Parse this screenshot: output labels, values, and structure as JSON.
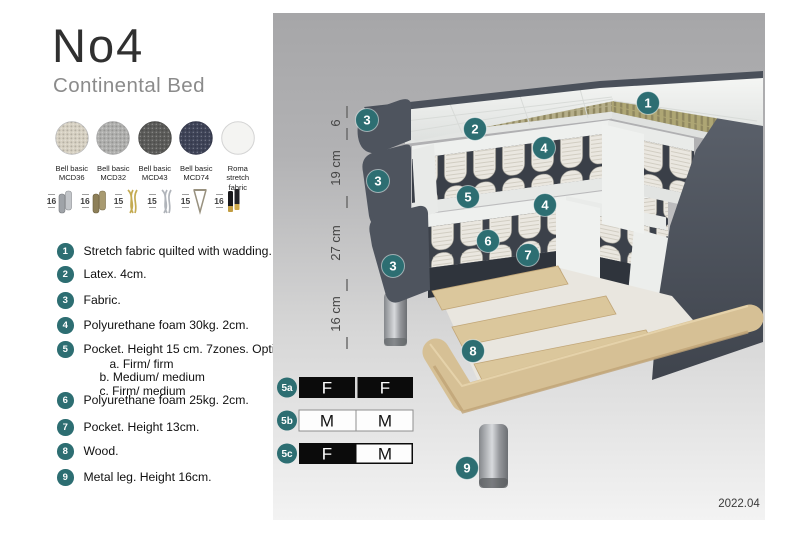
{
  "header": {
    "title": "No4",
    "subtitle": "Continental Bed"
  },
  "fabrics": [
    {
      "name": "Bell basic",
      "code": "MCD36",
      "color": "#d8d2c4"
    },
    {
      "name": "Bell basic",
      "code": "MCD32",
      "color": "#b1b1af"
    },
    {
      "name": "Bell basic",
      "code": "MCD43",
      "color": "#5c5c5a"
    },
    {
      "name": "Bell basic",
      "code": "MCD74",
      "color": "#3f4458"
    },
    {
      "name": "Roma",
      "code": "stretch fabric",
      "color": "#f4f4f2"
    }
  ],
  "legs": [
    {
      "height": "16",
      "style": "cylinder-silver"
    },
    {
      "height": "16",
      "style": "cylinder-bronze"
    },
    {
      "height": "15",
      "style": "twisted-gold"
    },
    {
      "height": "15",
      "style": "twisted-silver"
    },
    {
      "height": "15",
      "style": "hairpin-metal"
    },
    {
      "height": "16",
      "style": "black-gold-tip"
    }
  ],
  "features": [
    {
      "num": "1",
      "text": "Stretch fabric quilted with wadding."
    },
    {
      "num": "2",
      "text": "Latex. 4cm."
    },
    {
      "num": "3",
      "text": "Fabric."
    },
    {
      "num": "4",
      "text": "Polyurethane foam 30kg. 2cm."
    },
    {
      "num": "5",
      "text": "Pocket. Height 15 cm. 7zones. Option:",
      "options": [
        "a. Firm/ firm",
        "b. Medium/ medium",
        "c. Firm/ medium"
      ]
    },
    {
      "num": "6",
      "text": "Polyurethane foam 25kg. 2cm."
    },
    {
      "num": "7",
      "text": "Pocket. Height 13cm."
    },
    {
      "num": "8",
      "text": "Wood."
    },
    {
      "num": "9",
      "text": "Metal leg. Height 16cm."
    }
  ],
  "diagram": {
    "dimensions": [
      {
        "label": "6"
      },
      {
        "label": "19 cm"
      },
      {
        "label": "27 cm"
      },
      {
        "label": "16 cm"
      }
    ],
    "callouts": [
      "1",
      "2",
      "3",
      "4",
      "3",
      "5",
      "4",
      "6",
      "7",
      "3",
      "8",
      "9"
    ],
    "firmness_options": [
      {
        "id": "5a",
        "cells": [
          "F",
          "F"
        ]
      },
      {
        "id": "5b",
        "cells": [
          "M",
          "M"
        ]
      },
      {
        "id": "5c",
        "cells": [
          "F",
          "M"
        ]
      }
    ],
    "version": "2022.04",
    "colors": {
      "callout": "#2d6e72",
      "upholstery": "#4e545e",
      "latex": "#b5ae89",
      "springs": "#e9e6df",
      "wood": "#dccaa2",
      "metal_leg": "#c2c4c8"
    }
  }
}
